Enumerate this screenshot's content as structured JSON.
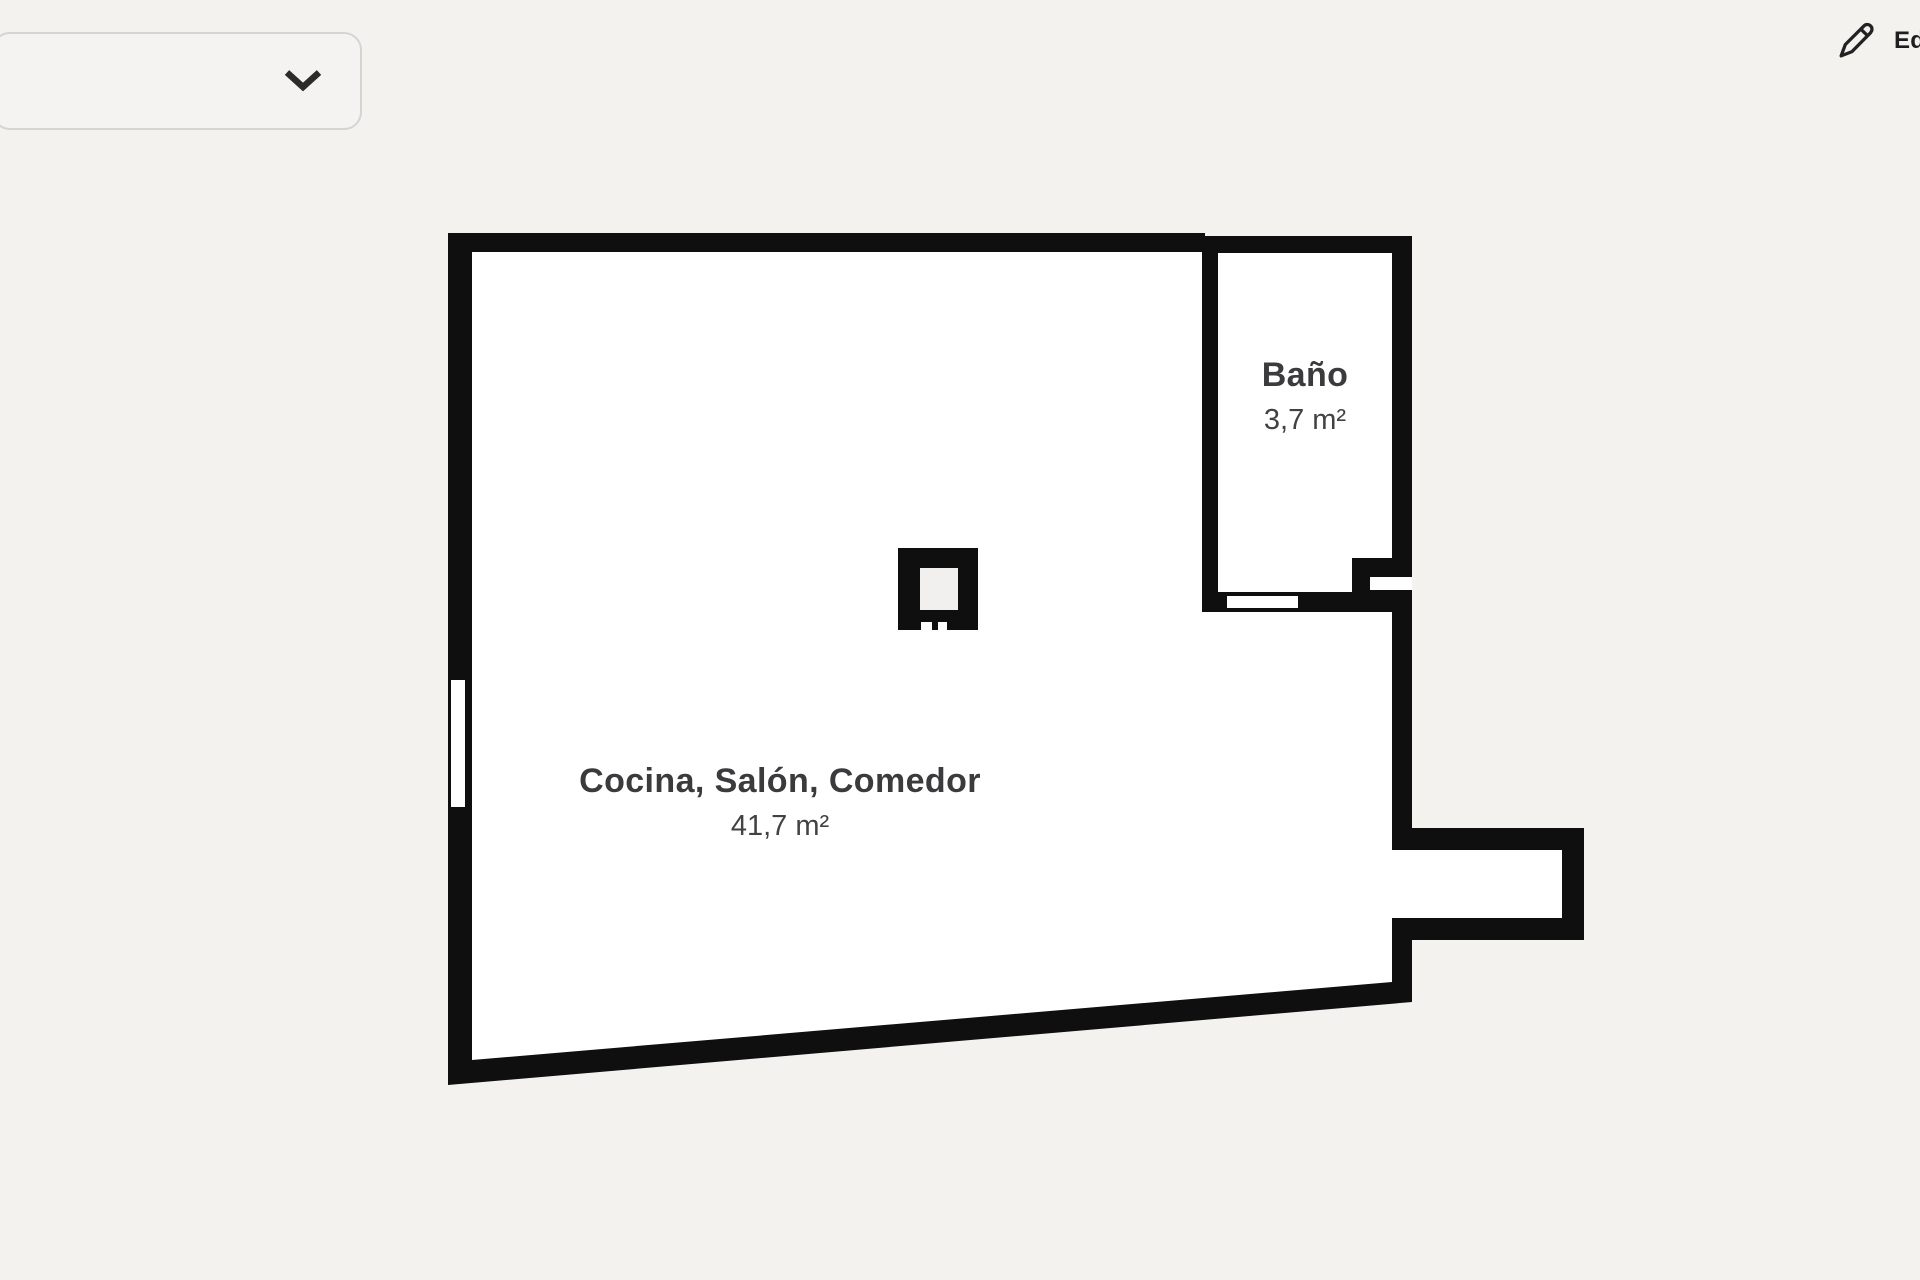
{
  "page": {
    "background": "#f3f2ef"
  },
  "toolbar": {
    "floor_select": {
      "value": "",
      "icon": "chevron-down",
      "icon_color": "#2b2b2b"
    },
    "edit_button": {
      "label": "Editar",
      "icon": "pencil",
      "icon_color": "#222222"
    }
  },
  "floorplan": {
    "wall_color": "#0f0f0f",
    "floor_color": "#ffffff",
    "pillar_core_color": "#f1f0ee",
    "rooms": [
      {
        "name": "Cocina, Salón, Comedor",
        "area": "41,7 m²"
      },
      {
        "name": "Baño",
        "area": "3,7 m²"
      }
    ]
  }
}
